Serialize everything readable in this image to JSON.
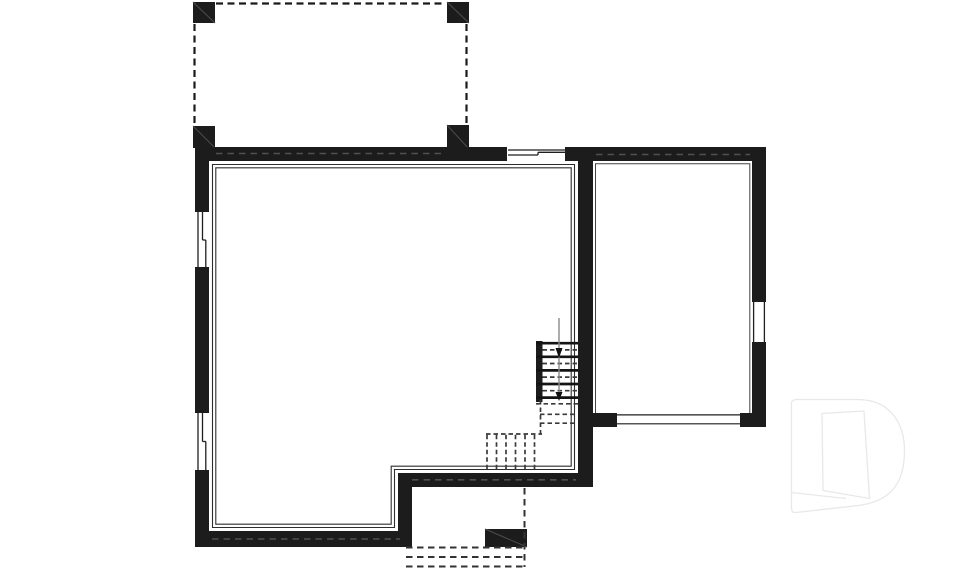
{
  "page": {
    "kind": "architectural-floor-plan",
    "level": "basement",
    "background": "#ffffff"
  },
  "colors": {
    "background": "#ffffff",
    "wall": "#1c1c1c",
    "line": "#1f1f1f",
    "dash": "#1a1a1a",
    "hidden": "#505050",
    "thin": "#2e2e2e",
    "innerline": "#444444",
    "graydir": "#8a8a8a",
    "watermark": "#e8e8e8",
    "postdiag": "#4d4d4d"
  },
  "plan": {
    "deck_above": {
      "posts": 4,
      "outline_style": "dashed"
    },
    "windows": [
      {
        "name": "top-wall-window"
      },
      {
        "name": "left-wall-window-upper"
      },
      {
        "name": "left-wall-window-lower"
      },
      {
        "name": "right-room-right-wall-window"
      }
    ],
    "right_room": {
      "bottom_opening": "garage-door-opening"
    },
    "staircase": {
      "solid_tread_lines": 5,
      "hidden_tread_lines": 6,
      "landing_style": "dashed",
      "direction_line": "vertical-with-down-arrows"
    },
    "exterior_steps_below": {
      "dashed_lines": 3,
      "support_post": 1
    },
    "watermark": {
      "letter": "D"
    }
  }
}
